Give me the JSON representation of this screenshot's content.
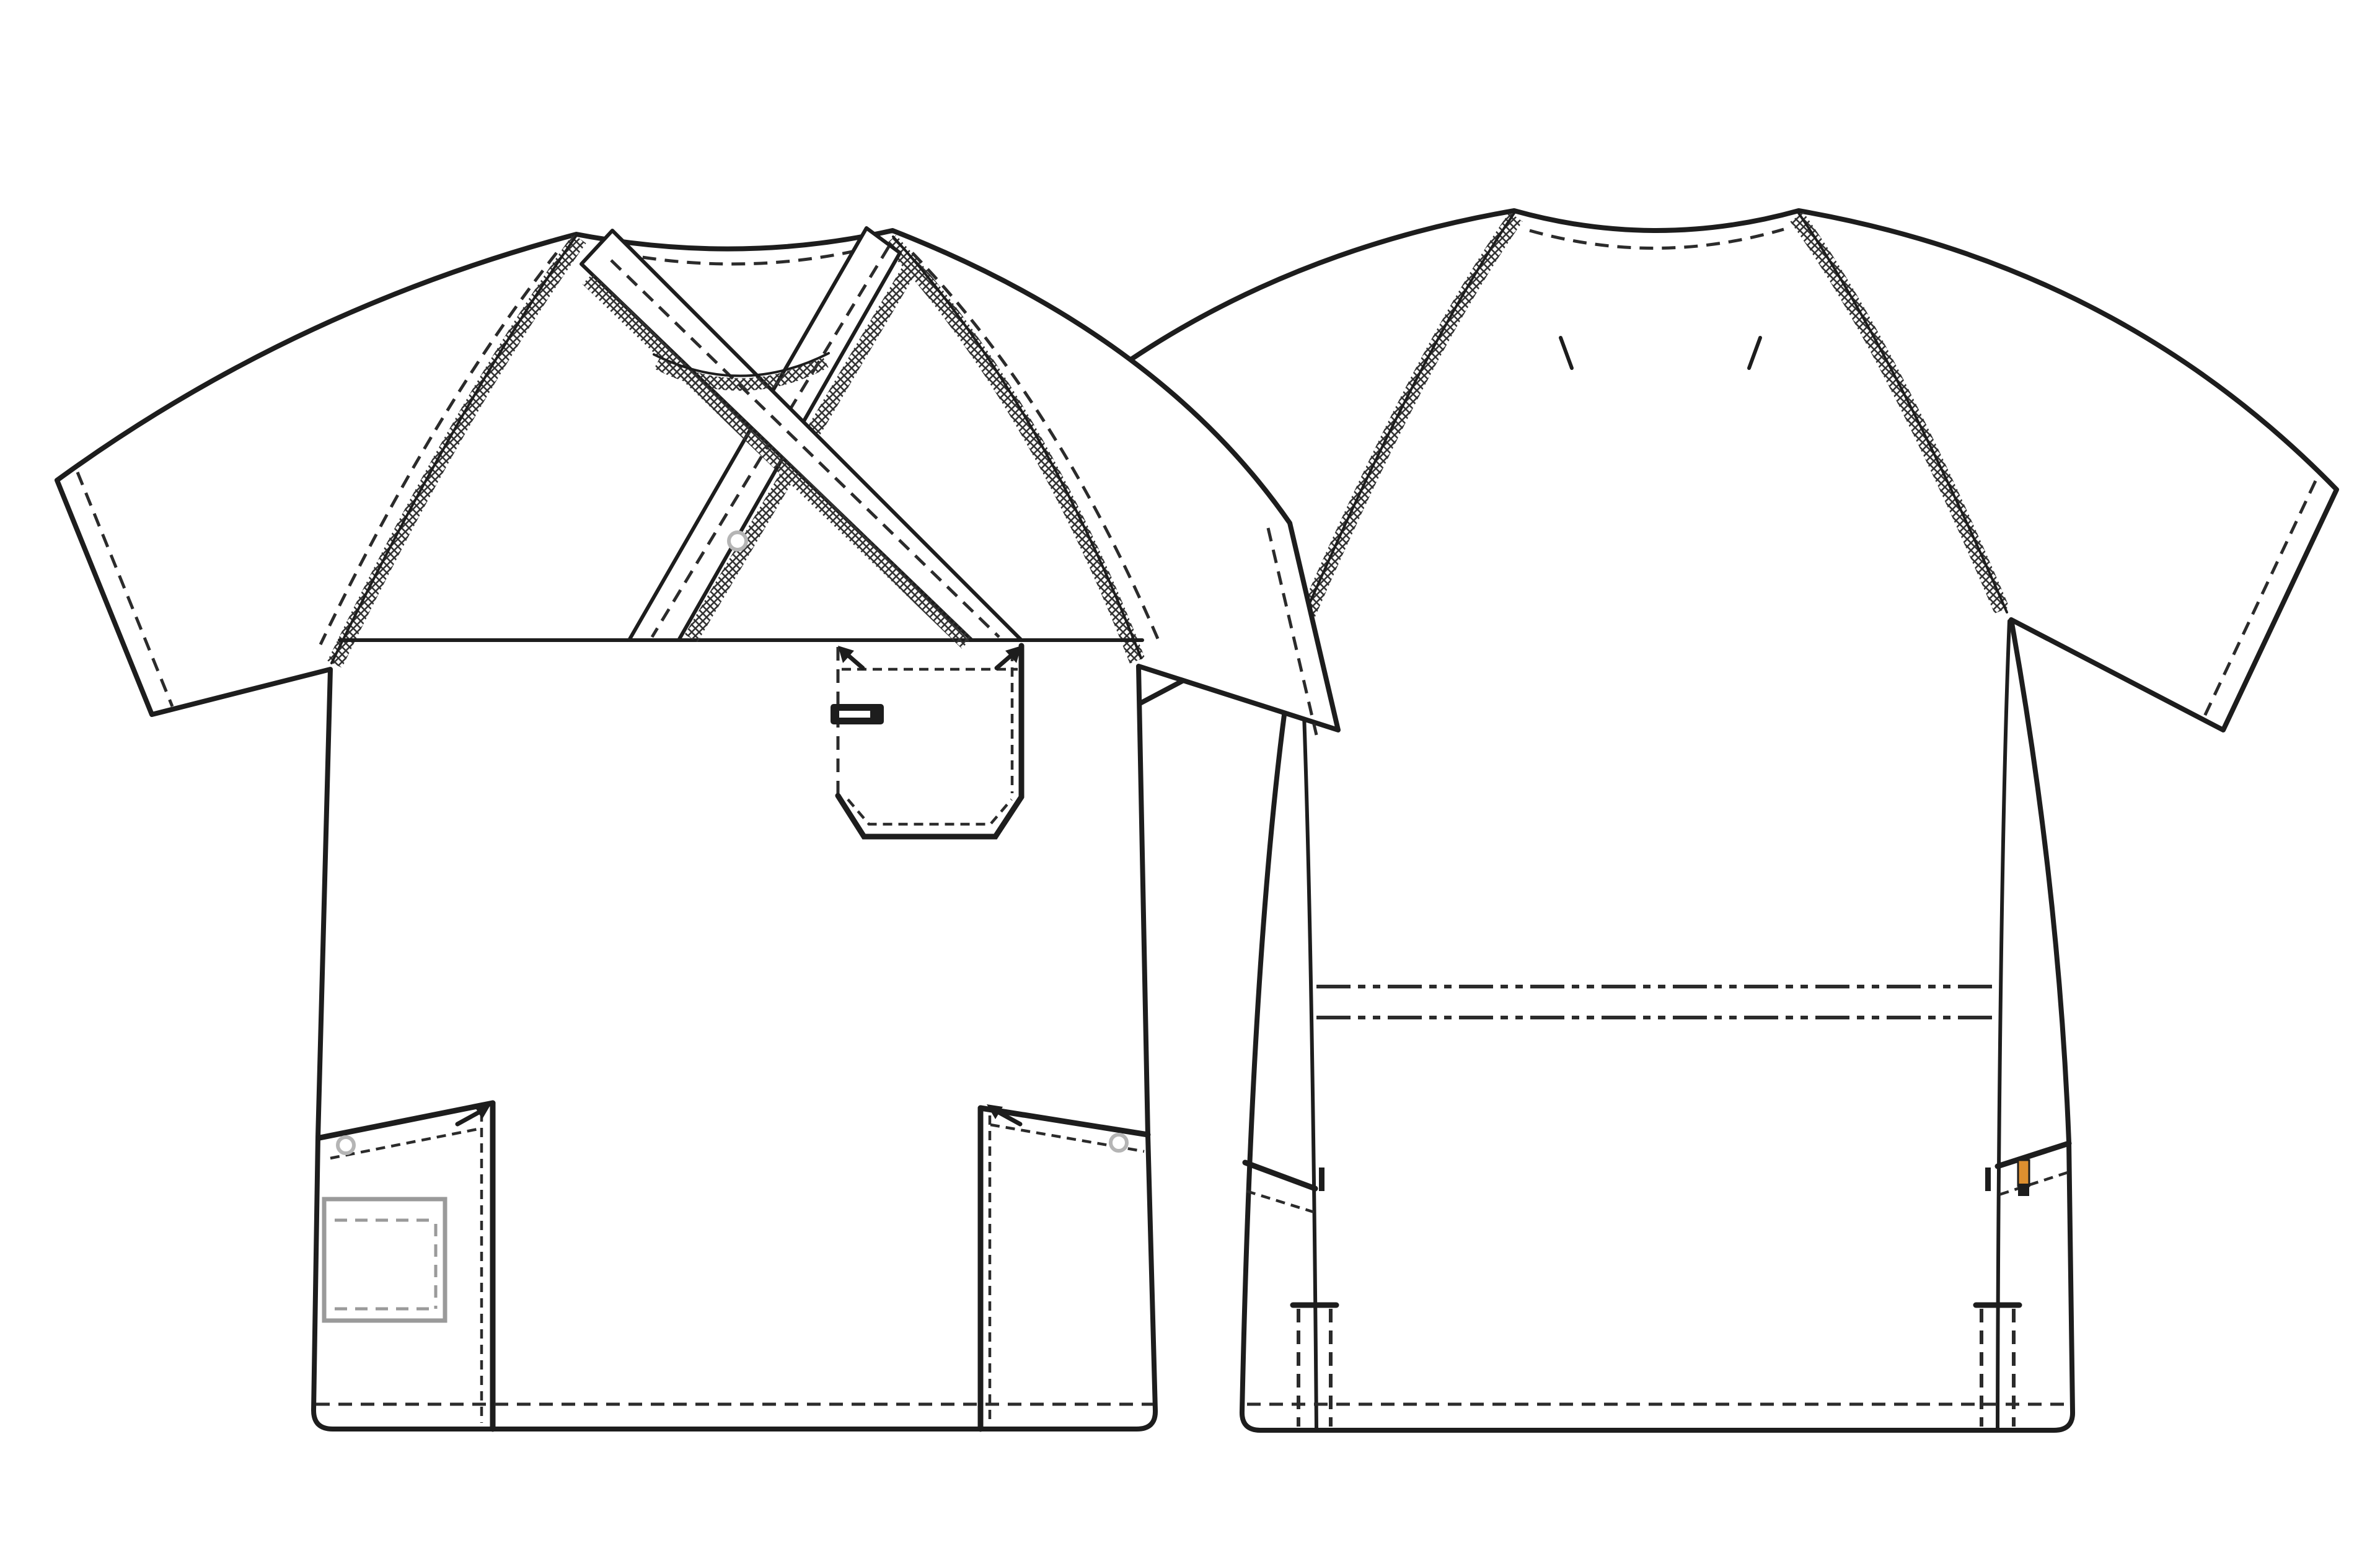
{
  "page": {
    "title": "Medical scrub top - technical flat sketch (front and back views)",
    "background": "#ffffff"
  },
  "colors": {
    "line": "#1d1d1d",
    "stitch": "#2b2b2b",
    "serge": "#333333",
    "snap_ring": "#b5b5b5",
    "inner_pocket_gray": "#9a9a9a",
    "label_orange": "#dd8f2f",
    "fabric": "#ffffff",
    "background": "#ffffff"
  },
  "views": {
    "front": {
      "name": "front view",
      "features": [
        "mock-wrap crossover v-neck with overlock (serge) trimmed bands",
        "round inner neckline with overlock stitching",
        "raglan sleeves with overlock trimmed seams",
        "snap button at crossover",
        "horizontal chest yoke seam",
        "chest patch pocket with clipped corners, topstitching, bartack arrows and black pen/badge slot",
        "two slanted lower patch pockets with snaps, bartack arrows and topstitching",
        "hidden interior pocket shown in gray inside left lower pocket",
        "twin-needle hem and sleeve-opening topstitching shown as dashed lines"
      ]
    },
    "back": {
      "name": "back view",
      "features": [
        "plain back with raglan sleeves and overlock trimmed seams",
        "back neckline topstitching",
        "two shoulder notch marks",
        "princess-style side panel seams",
        "double dash-dot waist topstitch lines across mid back",
        "side-entry pocket openings on side panels with bartacks",
        "orange woven brand label on right side pocket opening",
        "hem side slits shown with dashed stitching",
        "dashed hem topstitch line"
      ]
    }
  },
  "legend": {
    "solid_line": "cut edge / seam",
    "dashed_line": "topstitching",
    "hatched_band": "overlock / coverstitch trim",
    "gray_shape": "hidden interior detail"
  }
}
